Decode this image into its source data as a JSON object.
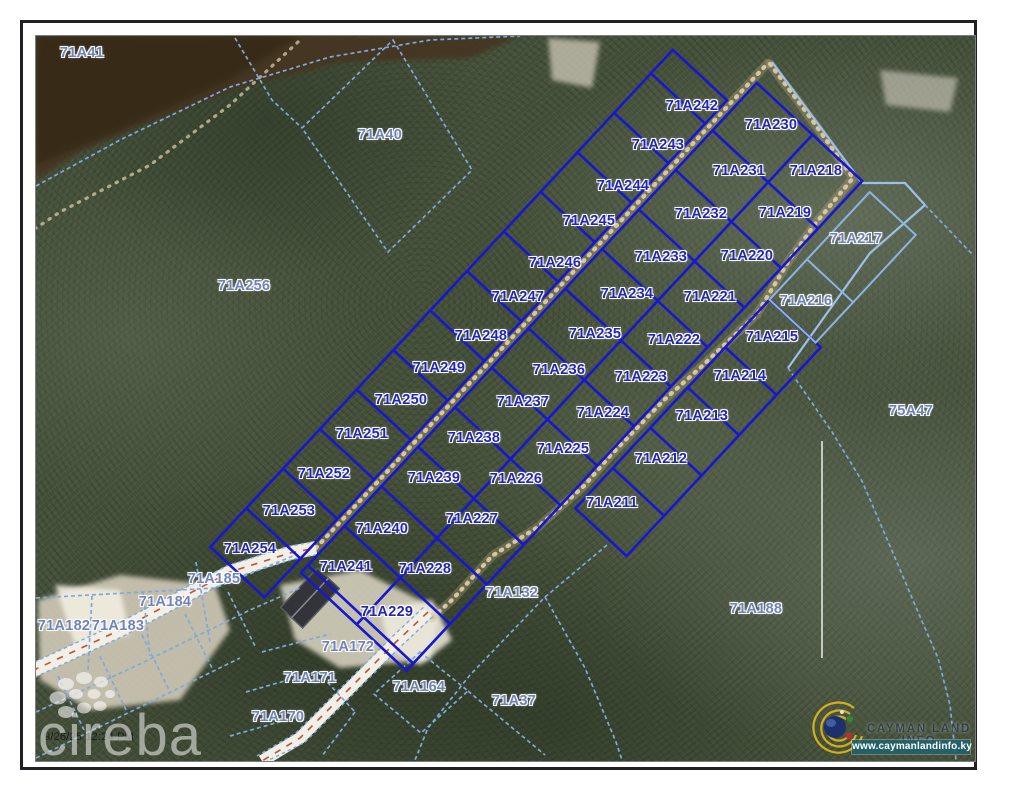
{
  "overlay": {
    "timestamp": "9/26/25 12:24 PM",
    "watermark_brand": "cireba",
    "logo_title": "CAYMAN LAND INFO",
    "logo_url": "www.caymanlandinfo.ky"
  },
  "map": {
    "subdivision_lots": [
      {
        "label": "71A242",
        "x": 692,
        "y": 106
      },
      {
        "label": "71A243",
        "x": 658,
        "y": 145
      },
      {
        "label": "71A244",
        "x": 623,
        "y": 186
      },
      {
        "label": "71A245",
        "x": 589,
        "y": 221
      },
      {
        "label": "71A246",
        "x": 555,
        "y": 263
      },
      {
        "label": "71A247",
        "x": 518,
        "y": 297
      },
      {
        "label": "71A248",
        "x": 481,
        "y": 336
      },
      {
        "label": "71A249",
        "x": 439,
        "y": 368
      },
      {
        "label": "71A250",
        "x": 401,
        "y": 400
      },
      {
        "label": "71A251",
        "x": 362,
        "y": 434
      },
      {
        "label": "71A252",
        "x": 324,
        "y": 474
      },
      {
        "label": "71A253",
        "x": 289,
        "y": 511
      },
      {
        "label": "71A254",
        "x": 250,
        "y": 549
      },
      {
        "label": "71A230",
        "x": 771,
        "y": 125
      },
      {
        "label": "71A231",
        "x": 739,
        "y": 171
      },
      {
        "label": "71A232",
        "x": 701,
        "y": 214
      },
      {
        "label": "71A233",
        "x": 661,
        "y": 257
      },
      {
        "label": "71A234",
        "x": 627,
        "y": 294
      },
      {
        "label": "71A235",
        "x": 595,
        "y": 334
      },
      {
        "label": "71A236",
        "x": 559,
        "y": 370
      },
      {
        "label": "71A237",
        "x": 523,
        "y": 402
      },
      {
        "label": "71A238",
        "x": 474,
        "y": 438
      },
      {
        "label": "71A239",
        "x": 434,
        "y": 478
      },
      {
        "label": "71A240",
        "x": 382,
        "y": 529
      },
      {
        "label": "71A241",
        "x": 346,
        "y": 567
      },
      {
        "label": "71A218",
        "x": 816,
        "y": 171
      },
      {
        "label": "71A219",
        "x": 785,
        "y": 213
      },
      {
        "label": "71A220",
        "x": 747,
        "y": 256
      },
      {
        "label": "71A221",
        "x": 710,
        "y": 297
      },
      {
        "label": "71A222",
        "x": 674,
        "y": 340
      },
      {
        "label": "71A223",
        "x": 641,
        "y": 377
      },
      {
        "label": "71A224",
        "x": 603,
        "y": 413
      },
      {
        "label": "71A225",
        "x": 563,
        "y": 449
      },
      {
        "label": "71A226",
        "x": 516,
        "y": 479
      },
      {
        "label": "71A227",
        "x": 472,
        "y": 519
      },
      {
        "label": "71A228",
        "x": 425,
        "y": 569
      },
      {
        "label": "71A229",
        "x": 387,
        "y": 612
      },
      {
        "label": "71A215",
        "x": 772,
        "y": 337
      },
      {
        "label": "71A214",
        "x": 740,
        "y": 376
      },
      {
        "label": "71A213",
        "x": 702,
        "y": 416
      },
      {
        "label": "71A212",
        "x": 661,
        "y": 459
      },
      {
        "label": "71A211",
        "x": 612,
        "y": 503
      }
    ],
    "surrounding_parcels": [
      {
        "label": "71A41",
        "x": 82,
        "y": 53
      },
      {
        "label": "71A40",
        "x": 380,
        "y": 135
      },
      {
        "label": "71A256",
        "x": 244,
        "y": 286
      },
      {
        "label": "71A217",
        "x": 856,
        "y": 239
      },
      {
        "label": "71A216",
        "x": 806,
        "y": 301
      },
      {
        "label": "75A47",
        "x": 911,
        "y": 411
      },
      {
        "label": "71A185",
        "x": 214,
        "y": 579
      },
      {
        "label": "71A184",
        "x": 165,
        "y": 602
      },
      {
        "label": "71A183",
        "x": 118,
        "y": 626
      },
      {
        "label": "71A182",
        "x": 64,
        "y": 626
      },
      {
        "label": "71A132",
        "x": 512,
        "y": 593
      },
      {
        "label": "71A188",
        "x": 756,
        "y": 609
      },
      {
        "label": "71A172",
        "x": 348,
        "y": 647
      },
      {
        "label": "71A171",
        "x": 310,
        "y": 678
      },
      {
        "label": "71A170",
        "x": 278,
        "y": 717
      },
      {
        "label": "71A164",
        "x": 419,
        "y": 687
      },
      {
        "label": "71A37",
        "x": 514,
        "y": 701
      }
    ]
  },
  "colors": {
    "lot_boundary": "#1717cf",
    "lot_label": "#2326b4",
    "parcel_boundary": "#7fa8dc",
    "parcel_label": "#6f83bb",
    "road_centerline": "#c0503a",
    "trail_dots": "#d9c69e",
    "logo_bar_teal": "#1e626e"
  }
}
